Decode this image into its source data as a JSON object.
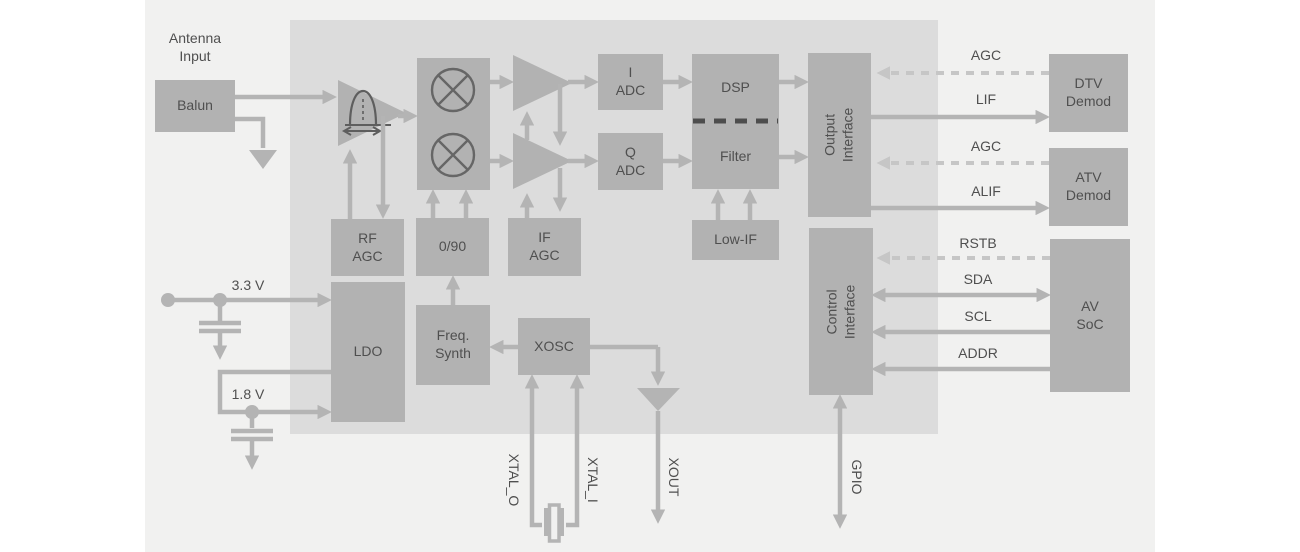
{
  "labels": {
    "antenna_input": "Antenna\nInput",
    "balun": "Balun",
    "pga_i": "PGA",
    "pga_q": "PGA",
    "adc_i": "I\nADC",
    "adc_q": "Q\nADC",
    "dsp": "DSP",
    "filter": "Filter",
    "output_interface": "Output\nInterface",
    "low_if": "Low-IF",
    "control_interface": "Control\nInterface",
    "rf_agc": "RF\nAGC",
    "phase": "0/90",
    "if_agc": "IF\nAGC",
    "ldo": "LDO",
    "freq_synth": "Freq.\nSynth",
    "xosc": "XOSC",
    "dtv_demod": "DTV\nDemod",
    "atv_demod": "ATV\nDemod",
    "av_soc": "AV\nSoC",
    "v33": "3.3 V",
    "v18": "1.8 V",
    "agc_dtv": "AGC",
    "lif": "LIF",
    "agc_atv": "AGC",
    "alif": "ALIF",
    "rstb": "RSTB",
    "sda": "SDA",
    "scl": "SCL",
    "addr": "ADDR",
    "xtal_o": "XTAL_O",
    "xtal_i": "XTAL_I",
    "xout": "XOUT",
    "gpio": "GPIO"
  },
  "colors": {
    "background": "#ffffff",
    "panel": "#f1f1f0",
    "chip_body": "#dcdcdc",
    "block_fill": "#b2b2b2",
    "wire": "#b4b4b4",
    "wire_dashed": "#c6c6c6",
    "icon_stroke": "#5e5e5e",
    "divider_dash": "#4d4d4d",
    "text": "#4f4f4f"
  }
}
